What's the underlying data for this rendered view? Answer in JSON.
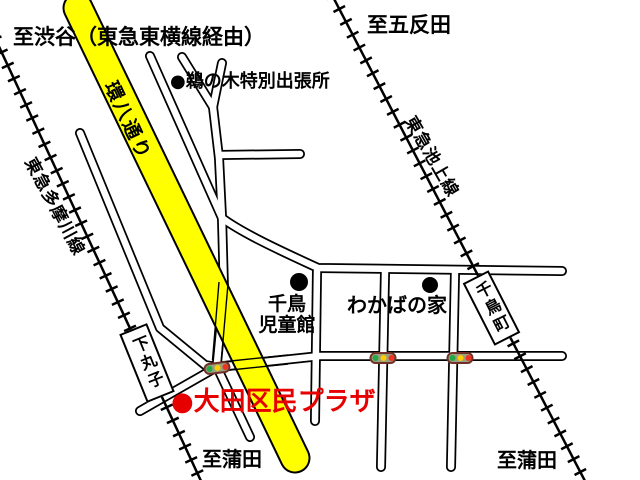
{
  "labels": {
    "to_shibuya": "至渋谷（東急東横線経由）",
    "to_gotanda": "至五反田",
    "unoki_branch_office": "●鵜の木特別出張所",
    "kanpachi_road": "環八通り",
    "tamagawa_line": "東急多摩川線",
    "ikegami_line": "東急池上線",
    "chidori_jidokan_line1": "千鳥",
    "chidori_jidokan_line2": "児童館",
    "wakaba_house": "わかばの家",
    "ota_plaza": "●大田区民プラザ",
    "to_kamata_left": "至蒲田",
    "to_kamata_right": "至蒲田"
  },
  "stations": [
    {
      "name": "下丸子"
    },
    {
      "name": "千鳥町"
    }
  ],
  "traffic_lights": [
    {
      "x": 217,
      "y": 368,
      "angle": -7
    },
    {
      "x": 383,
      "y": 358,
      "angle": 0
    },
    {
      "x": 460,
      "y": 358,
      "angle": 0
    }
  ],
  "colors": {
    "road_highlight": "#ffff00",
    "plaza_label": "#e60000",
    "signal_green": "#22a844",
    "signal_yellow": "#ffcc00",
    "signal_red": "#ee3322",
    "signal_body": "#9aa080",
    "signal_border": "#703028"
  }
}
